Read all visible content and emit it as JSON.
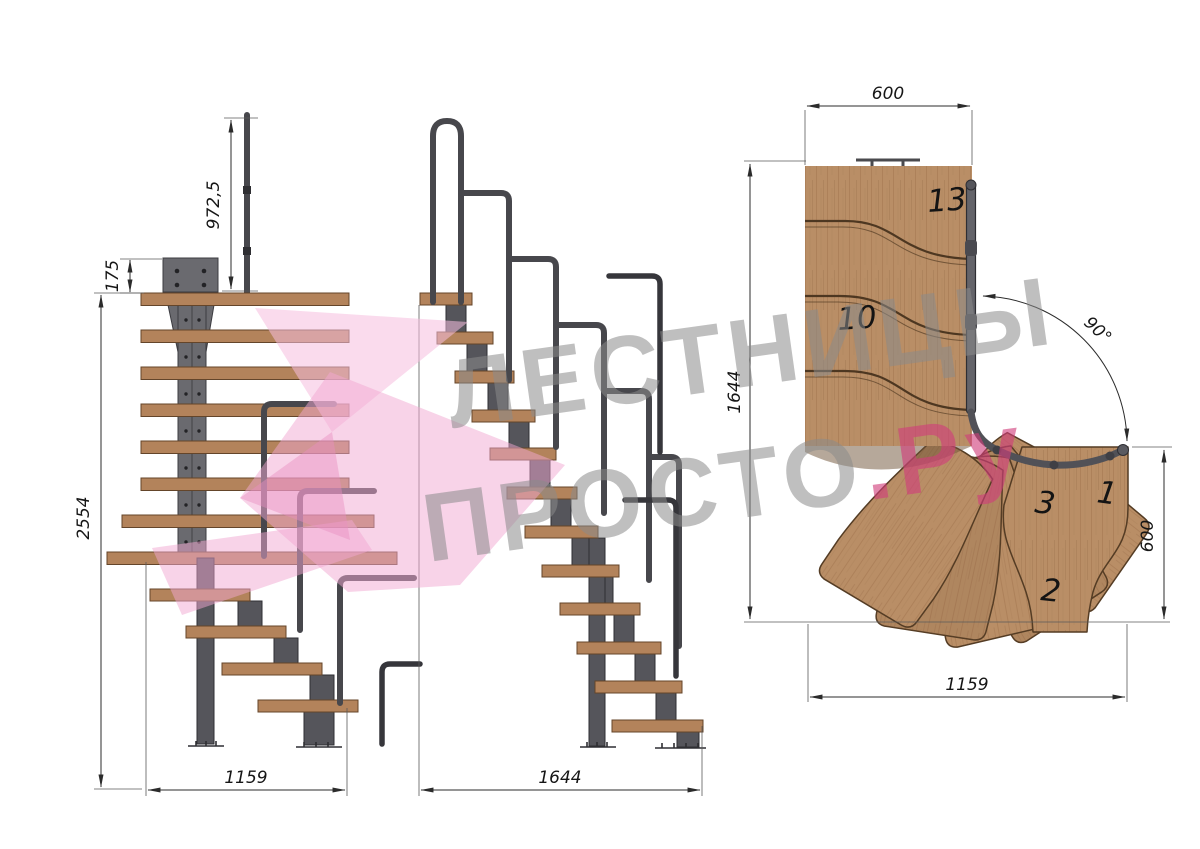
{
  "watermark": {
    "brand_line1": "ЛЕСТНИЦЫ",
    "brand_line2": "ПРОСТО",
    "brand_line2_suffix": ".Ру"
  },
  "side_view": {
    "rail_height": "972,5",
    "mount_plate_height": "175",
    "total_height": "2554",
    "run_length": "1159"
  },
  "front_view": {
    "run_length": "1644"
  },
  "plan_view": {
    "landing_width": "600",
    "plan_depth": "1644",
    "turn_angle": "90°",
    "exit_width": "600",
    "plan_length": "1159",
    "tread_13": "13",
    "tread_10": "10",
    "tread_3": "3",
    "tread_1": "1",
    "tread_2": "2"
  },
  "colors": {
    "wood": "#b98e66",
    "metal": "#6a6a6f",
    "dimension_lines": "#2b2b2b",
    "watermark_gray": "#8a8a8a",
    "watermark_pink": "#d13e7a",
    "logo_pink": "#f2a8d2"
  }
}
